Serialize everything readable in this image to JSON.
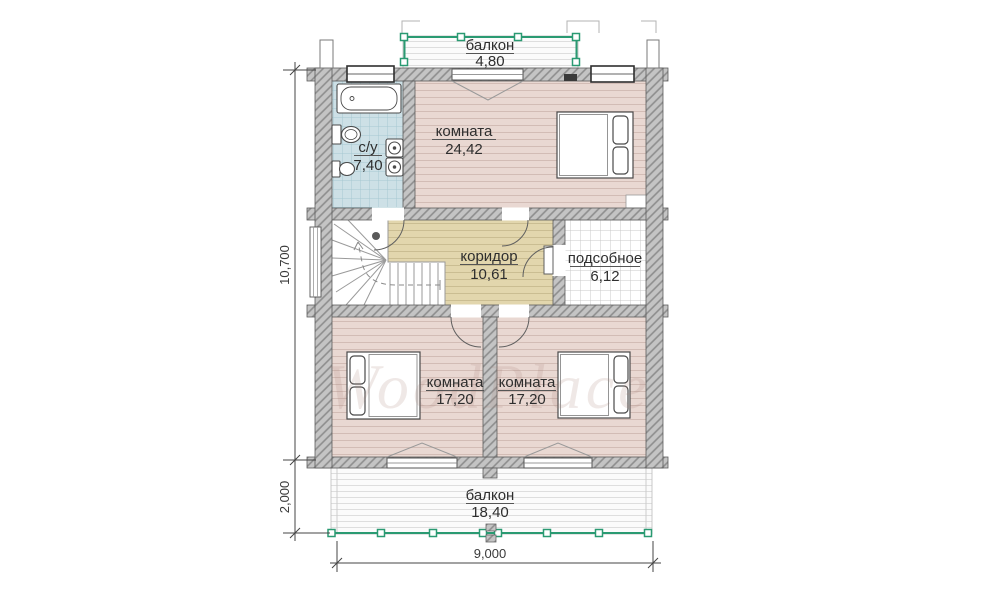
{
  "rooms": {
    "balcony_top": {
      "label": "балкон",
      "area": "4,80"
    },
    "bedroom_top": {
      "label": "комната",
      "area": "24,42"
    },
    "bathroom": {
      "label": "с/у",
      "area": "7,40"
    },
    "corridor": {
      "label": "коридор",
      "area": "10,61"
    },
    "utility": {
      "label": "подсобное",
      "area": "6,12"
    },
    "bedroom_left": {
      "label": "комната",
      "area": "17,20"
    },
    "bedroom_right": {
      "label": "комната",
      "area": "17,20"
    },
    "balcony_bottom": {
      "label": "балкон",
      "area": "18,40"
    }
  },
  "dimensions": {
    "total_depth": "10,700",
    "balcony_depth": "2,000",
    "total_width": "9,000"
  },
  "watermark": "WoodPlace",
  "colors": {
    "railing_green": "#2a9a72",
    "wall_gray": "#c4c4c4",
    "floor_pink": "#e9d8d2",
    "floor_tan": "#e2d6ad",
    "floor_blue": "#cde0e6"
  }
}
